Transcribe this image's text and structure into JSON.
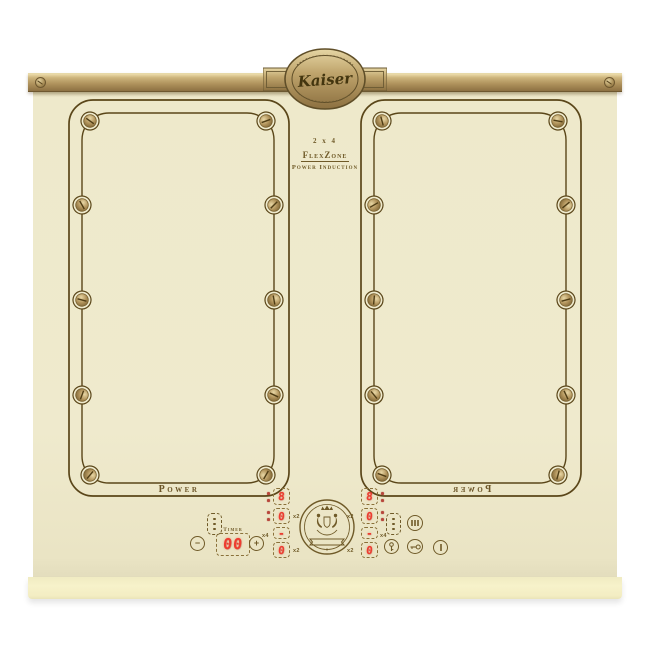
{
  "badge": {
    "brand": "Kaiser"
  },
  "spec": {
    "line1": "2 x 4",
    "line2": "FlexZone",
    "line3": "Power Induction"
  },
  "zones": {
    "left_label": "Power",
    "right_label": "Power"
  },
  "panel": {
    "timer": {
      "label": "Timer",
      "value": "00"
    },
    "buttons": {
      "minus": "−",
      "plus": "+"
    },
    "left": {
      "d1": "8",
      "d2": "0",
      "d3": "-",
      "d4": "0",
      "m2a": "x2",
      "m4": "x4",
      "m2b": "x2"
    },
    "right": {
      "d1": "8",
      "d2": "0",
      "d3": "-",
      "d4": "0",
      "m2a": "x2",
      "m4": "x4",
      "m2b": "x2"
    }
  },
  "colors": {
    "glass": "#efeacd",
    "line": "#5a4619",
    "digit": "#ee3c30",
    "brass": "#b49a62",
    "label": "#6f5a28"
  }
}
